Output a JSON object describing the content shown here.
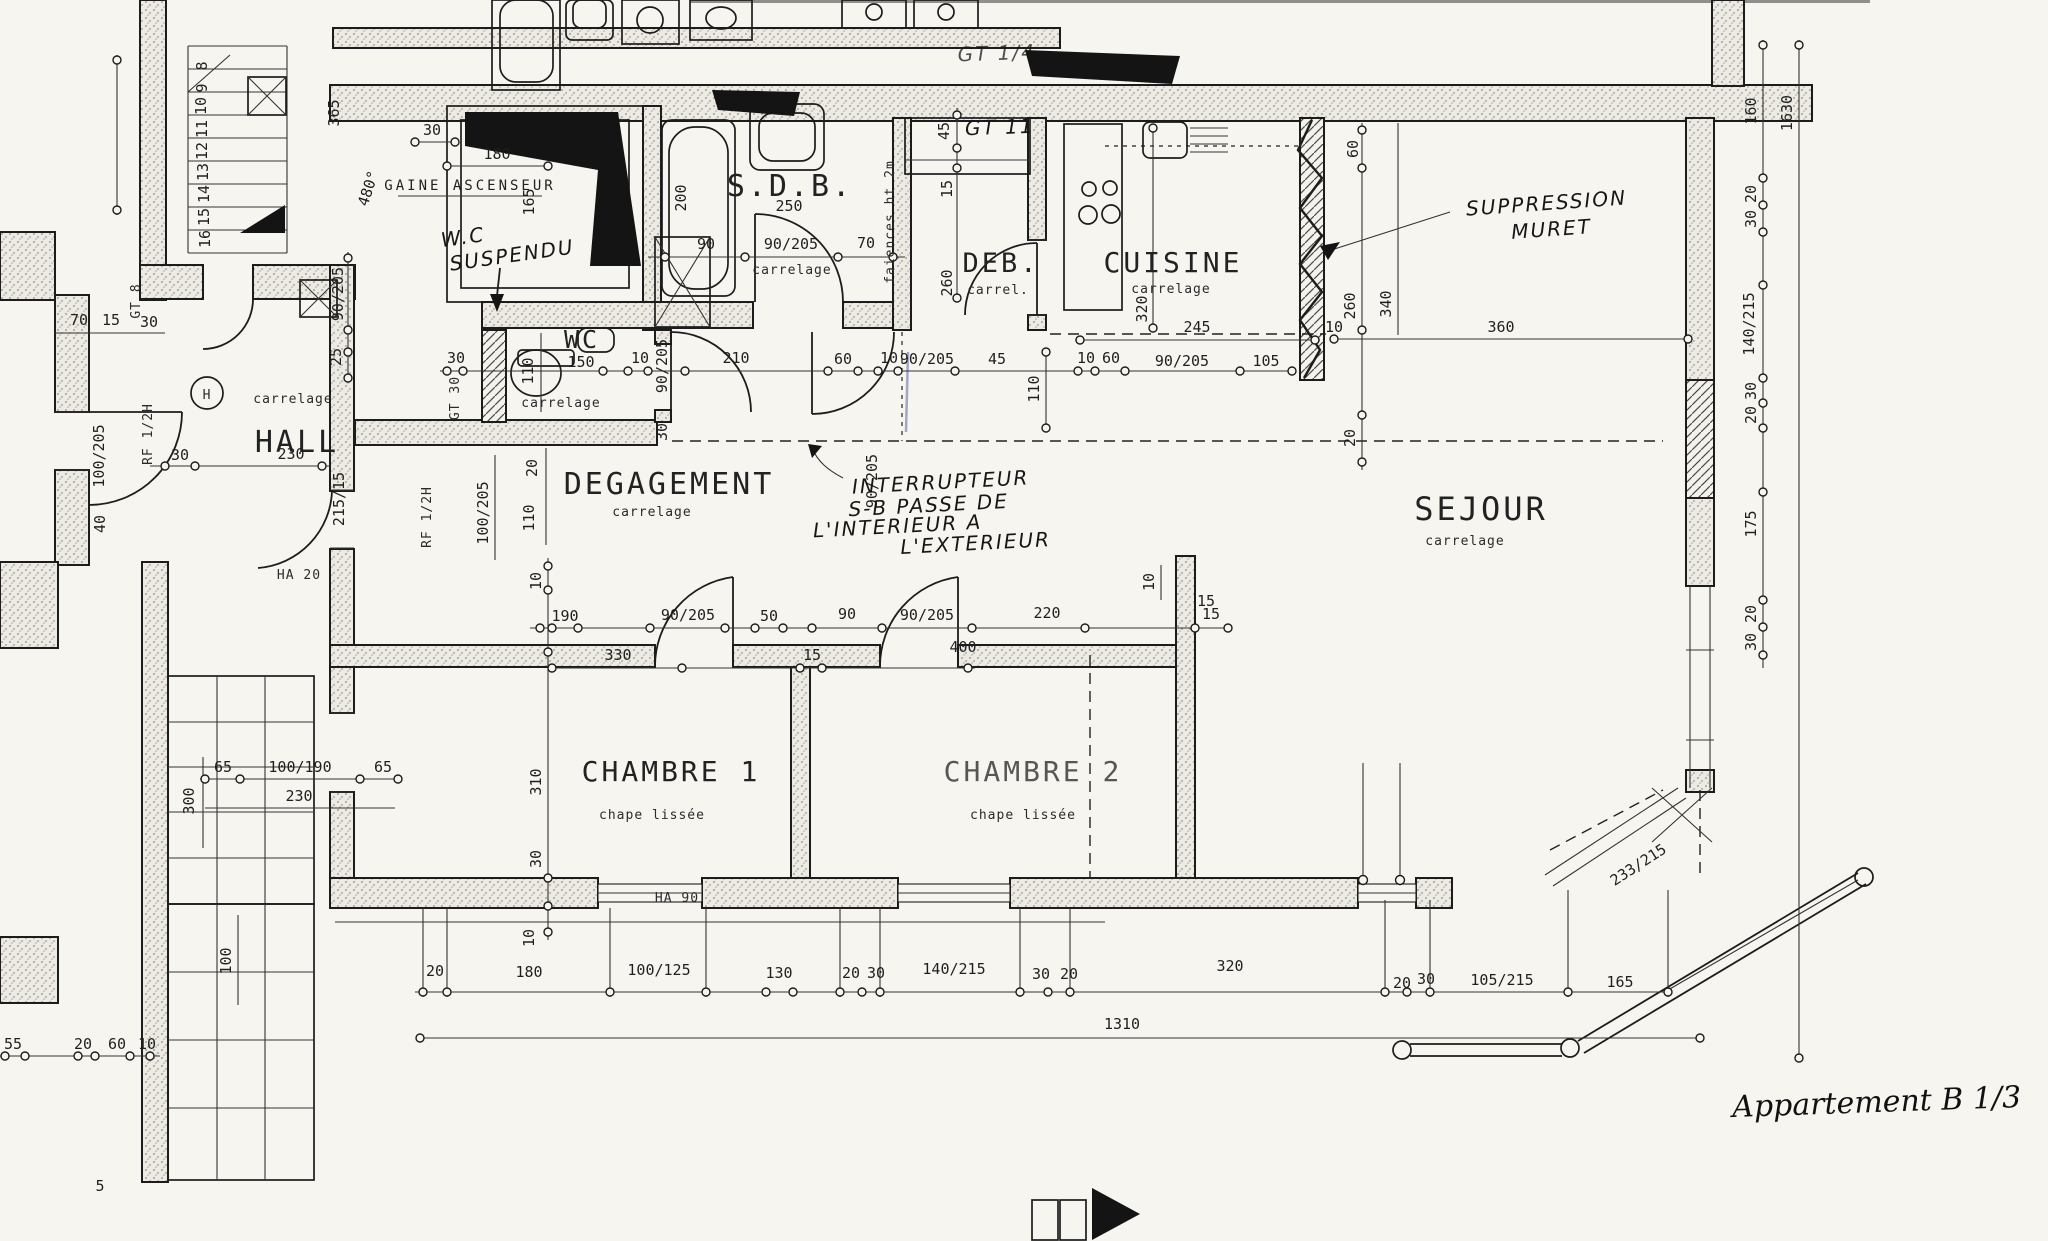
{
  "drawing": {
    "apartment_reference": "Appartement B 1/3",
    "plan_type_rooms": [
      "HALL",
      "DEGAGEMENT",
      "WC",
      "S.D.B.",
      "DEB.",
      "CUISINE",
      "SEJOUR",
      "CHAMBRE 1",
      "CHAMBRE 2",
      "GAINE ASCENSEUR"
    ],
    "floor_finishes": [
      "carrelage",
      "chape lissée",
      "faiences ht 2m"
    ],
    "handwritten_notes": [
      "W.C SUSPENDU",
      "SUPPRESSION MURET",
      "INTERRUPTEUR S-B PASSE DE L'INTERIEUR A L'EXTERIEUR",
      "GT 11",
      "Appartement B 1/3"
    ]
  },
  "labels": {
    "rooms": [
      {
        "t": "HALL",
        "x": 297,
        "y": 452,
        "s": 30
      },
      {
        "t": "DEGAGEMENT",
        "x": 669,
        "y": 494,
        "s": 30
      },
      {
        "t": "S.D.B.",
        "x": 790,
        "y": 196,
        "s": 30
      },
      {
        "t": "DEB.",
        "x": 1001,
        "y": 272,
        "s": 27
      },
      {
        "t": "CUISINE",
        "x": 1173,
        "y": 272,
        "s": 28
      },
      {
        "t": "SEJOUR",
        "x": 1481,
        "y": 520,
        "s": 32
      },
      {
        "t": "CHAMBRE 1",
        "x": 671,
        "y": 781,
        "s": 28
      },
      {
        "t": "CHAMBRE 2",
        "x": 1033,
        "y": 781,
        "s": 28,
        "o": 0.75
      },
      {
        "t": "WC",
        "x": 582,
        "y": 348,
        "s": 25
      },
      {
        "t": "GAINE ASCENSEUR",
        "x": 470,
        "y": 190,
        "s": 14
      }
    ],
    "subs": [
      {
        "t": "carrelage",
        "x": 293,
        "y": 403
      },
      {
        "t": "carrelage",
        "x": 652,
        "y": 516
      },
      {
        "t": "carrelage",
        "x": 561,
        "y": 407
      },
      {
        "t": "carrelage",
        "x": 792,
        "y": 274
      },
      {
        "t": "carrel.",
        "x": 998,
        "y": 294
      },
      {
        "t": "carrelage",
        "x": 1171,
        "y": 293
      },
      {
        "t": "carrelage",
        "x": 1465,
        "y": 545
      },
      {
        "t": "chape lissée",
        "x": 652,
        "y": 819
      },
      {
        "t": "chape lissée",
        "x": 1023,
        "y": 819
      },
      {
        "t": "HA 20",
        "x": 299,
        "y": 579,
        "s": 15
      },
      {
        "t": "HA 90",
        "x": 677,
        "y": 902,
        "s": 15
      },
      {
        "t": "faiences ht 2m",
        "x": 894,
        "y": 222,
        "r": -90
      },
      {
        "t": "RF 1/2H",
        "x": 152,
        "y": 434,
        "r": -90
      },
      {
        "t": "RF 1/2H",
        "x": 431,
        "y": 517,
        "r": -90
      },
      {
        "t": "GT 8",
        "x": 140,
        "y": 301,
        "r": -90,
        "s": 12
      },
      {
        "t": "GT 30",
        "x": 459,
        "y": 398,
        "r": -90,
        "s": 12
      },
      {
        "t": "H",
        "x": 207,
        "y": 399,
        "s": 16
      }
    ],
    "dims": [
      {
        "t": "365",
        "x": 339,
        "y": 113,
        "r": -90
      },
      {
        "t": "30",
        "x": 432,
        "y": 135
      },
      {
        "t": "180",
        "x": 497,
        "y": 159
      },
      {
        "t": "165",
        "x": 534,
        "y": 202,
        "r": -90
      },
      {
        "t": "480°",
        "x": 373,
        "y": 190,
        "r": -72
      },
      {
        "t": "70",
        "x": 79,
        "y": 325
      },
      {
        "t": "15",
        "x": 111,
        "y": 325
      },
      {
        "t": "30",
        "x": 149,
        "y": 327
      },
      {
        "t": "90/205",
        "x": 343,
        "y": 294,
        "r": -90
      },
      {
        "t": "25",
        "x": 341,
        "y": 357,
        "r": -90
      },
      {
        "t": "100/205",
        "x": 104,
        "y": 456,
        "r": -90
      },
      {
        "t": "30",
        "x": 180,
        "y": 460
      },
      {
        "t": "40",
        "x": 105,
        "y": 524,
        "r": -90
      },
      {
        "t": "230",
        "x": 291,
        "y": 459
      },
      {
        "t": "215/15",
        "x": 344,
        "y": 499,
        "r": -90
      },
      {
        "t": "200",
        "x": 686,
        "y": 198,
        "r": -90
      },
      {
        "t": "250",
        "x": 789,
        "y": 211
      },
      {
        "t": "90",
        "x": 706,
        "y": 249
      },
      {
        "t": "90/205",
        "x": 791,
        "y": 249
      },
      {
        "t": "70",
        "x": 866,
        "y": 248
      },
      {
        "t": "45",
        "x": 949,
        "y": 131,
        "r": -90
      },
      {
        "t": "15",
        "x": 952,
        "y": 189,
        "r": -90
      },
      {
        "t": "260",
        "x": 952,
        "y": 283,
        "r": -90
      },
      {
        "t": "30",
        "x": 456,
        "y": 363
      },
      {
        "t": "110",
        "x": 533,
        "y": 371,
        "r": -90
      },
      {
        "t": "150",
        "x": 581,
        "y": 367
      },
      {
        "t": "10",
        "x": 640,
        "y": 363
      },
      {
        "t": "90/205",
        "x": 667,
        "y": 366,
        "r": -90
      },
      {
        "t": "210",
        "x": 736,
        "y": 363
      },
      {
        "t": "30",
        "x": 667,
        "y": 432,
        "r": -90
      },
      {
        "t": "60",
        "x": 843,
        "y": 364
      },
      {
        "t": "10",
        "x": 889,
        "y": 363
      },
      {
        "t": "90/205",
        "x": 927,
        "y": 364
      },
      {
        "t": "45",
        "x": 997,
        "y": 364
      },
      {
        "t": "10",
        "x": 1086,
        "y": 363
      },
      {
        "t": "60",
        "x": 1111,
        "y": 363
      },
      {
        "t": "90/205",
        "x": 1182,
        "y": 366
      },
      {
        "t": "105",
        "x": 1266,
        "y": 366
      },
      {
        "t": "245",
        "x": 1197,
        "y": 332
      },
      {
        "t": "320",
        "x": 1147,
        "y": 309,
        "r": -90
      },
      {
        "t": "20",
        "x": 537,
        "y": 468,
        "r": -90
      },
      {
        "t": "110",
        "x": 534,
        "y": 518,
        "r": -90
      },
      {
        "t": "100/205",
        "x": 488,
        "y": 513,
        "r": -90
      },
      {
        "t": "90/205",
        "x": 877,
        "y": 481,
        "r": -90
      },
      {
        "t": "60",
        "x": 1358,
        "y": 149,
        "r": -90
      },
      {
        "t": "260",
        "x": 1355,
        "y": 306,
        "r": -90
      },
      {
        "t": "340",
        "x": 1391,
        "y": 304,
        "r": -90
      },
      {
        "t": "10",
        "x": 1334,
        "y": 332
      },
      {
        "t": "360",
        "x": 1501,
        "y": 332
      },
      {
        "t": "20",
        "x": 1355,
        "y": 438,
        "r": -90
      },
      {
        "t": "110",
        "x": 1039,
        "y": 389,
        "r": -90
      },
      {
        "t": "15",
        "x": 1206,
        "y": 606
      },
      {
        "t": "160",
        "x": 1756,
        "y": 111,
        "r": -90
      },
      {
        "t": "1630",
        "x": 1792,
        "y": 113,
        "r": -90
      },
      {
        "t": "20",
        "x": 1756,
        "y": 194,
        "r": -90
      },
      {
        "t": "30",
        "x": 1756,
        "y": 219,
        "r": -90
      },
      {
        "t": "140/215",
        "x": 1754,
        "y": 324,
        "r": -90
      },
      {
        "t": "30",
        "x": 1756,
        "y": 391,
        "r": -90
      },
      {
        "t": "20",
        "x": 1756,
        "y": 415,
        "r": -90
      },
      {
        "t": "175",
        "x": 1756,
        "y": 524,
        "r": -90
      },
      {
        "t": "20",
        "x": 1756,
        "y": 614,
        "r": -90
      },
      {
        "t": "30",
        "x": 1756,
        "y": 642,
        "r": -90
      },
      {
        "t": "10",
        "x": 541,
        "y": 581,
        "r": -90
      },
      {
        "t": "190",
        "x": 565,
        "y": 621
      },
      {
        "t": "90/205",
        "x": 688,
        "y": 620
      },
      {
        "t": "50",
        "x": 769,
        "y": 621
      },
      {
        "t": "90",
        "x": 847,
        "y": 619
      },
      {
        "t": "90/205",
        "x": 927,
        "y": 620
      },
      {
        "t": "220",
        "x": 1047,
        "y": 618
      },
      {
        "t": "15",
        "x": 1211,
        "y": 619
      },
      {
        "t": "330",
        "x": 618,
        "y": 660
      },
      {
        "t": "15",
        "x": 812,
        "y": 660
      },
      {
        "t": "400",
        "x": 963,
        "y": 652
      },
      {
        "t": "10",
        "x": 1154,
        "y": 582,
        "r": -90
      },
      {
        "t": "310",
        "x": 541,
        "y": 782,
        "r": -90
      },
      {
        "t": "30",
        "x": 541,
        "y": 859,
        "r": -90
      },
      {
        "t": "65",
        "x": 223,
        "y": 772
      },
      {
        "t": "100/190",
        "x": 300,
        "y": 772
      },
      {
        "t": "65",
        "x": 383,
        "y": 772
      },
      {
        "t": "230",
        "x": 299,
        "y": 801
      },
      {
        "t": "300",
        "x": 194,
        "y": 801,
        "r": -90
      },
      {
        "t": "100",
        "x": 231,
        "y": 961,
        "r": -90
      },
      {
        "t": "20",
        "x": 435,
        "y": 976
      },
      {
        "t": "180",
        "x": 529,
        "y": 977
      },
      {
        "t": "100/125",
        "x": 659,
        "y": 975
      },
      {
        "t": "130",
        "x": 779,
        "y": 978
      },
      {
        "t": "20",
        "x": 851,
        "y": 978
      },
      {
        "t": "30",
        "x": 876,
        "y": 978
      },
      {
        "t": "140/215",
        "x": 954,
        "y": 974
      },
      {
        "t": "30",
        "x": 1041,
        "y": 979
      },
      {
        "t": "20",
        "x": 1069,
        "y": 979
      },
      {
        "t": "320",
        "x": 1230,
        "y": 971
      },
      {
        "t": "20",
        "x": 1402,
        "y": 988
      },
      {
        "t": "30",
        "x": 1426,
        "y": 984
      },
      {
        "t": "105/215",
        "x": 1502,
        "y": 985
      },
      {
        "t": "165",
        "x": 1620,
        "y": 987
      },
      {
        "t": "10",
        "x": 534,
        "y": 938,
        "r": -90
      },
      {
        "t": "1310",
        "x": 1122,
        "y": 1029
      },
      {
        "t": "233/215",
        "x": 1641,
        "y": 869,
        "r": -33
      },
      {
        "t": "55",
        "x": 13,
        "y": 1049
      },
      {
        "t": "20",
        "x": 83,
        "y": 1049
      },
      {
        "t": "60",
        "x": 117,
        "y": 1049
      },
      {
        "t": "10",
        "x": 147,
        "y": 1049
      },
      {
        "t": "5",
        "x": 100,
        "y": 1191
      },
      {
        "t": "8",
        "x": 207,
        "y": 66,
        "r": -90,
        "s": 12
      },
      {
        "t": "9",
        "x": 207,
        "y": 88,
        "r": -90,
        "s": 12
      },
      {
        "t": "10",
        "x": 206,
        "y": 106,
        "r": -90,
        "s": 12
      },
      {
        "t": "11",
        "x": 207,
        "y": 129,
        "r": -90,
        "s": 12
      },
      {
        "t": "12",
        "x": 207,
        "y": 151,
        "r": -90,
        "s": 12
      },
      {
        "t": "13",
        "x": 208,
        "y": 172,
        "r": -90,
        "s": 12
      },
      {
        "t": "14",
        "x": 209,
        "y": 194,
        "r": -90,
        "s": 12
      },
      {
        "t": "15",
        "x": 209,
        "y": 217,
        "r": -90,
        "s": 12
      },
      {
        "t": "16",
        "x": 210,
        "y": 239,
        "r": -90,
        "s": 12
      }
    ],
    "hand": [
      {
        "t": "W.C",
        "x": 464,
        "y": 244,
        "r": -8,
        "s": 21
      },
      {
        "t": "SUSPENDU",
        "x": 513,
        "y": 262,
        "r": -8,
        "s": 20
      },
      {
        "t": "SUPPRESSION",
        "x": 1547,
        "y": 210,
        "r": -4,
        "s": 24
      },
      {
        "t": "MURET",
        "x": 1552,
        "y": 236,
        "r": -4,
        "s": 24
      },
      {
        "t": "INTERRUPTEUR",
        "x": 941,
        "y": 489,
        "r": -3,
        "s": 19
      },
      {
        "t": "S-B PASSE DE",
        "x": 929,
        "y": 512,
        "r": -3,
        "s": 19
      },
      {
        "t": "L'INTERIEUR A",
        "x": 898,
        "y": 533,
        "r": -3,
        "s": 19
      },
      {
        "t": "L'EXTERIEUR",
        "x": 976,
        "y": 550,
        "r": -3,
        "s": 19
      },
      {
        "t": "GT 11",
        "x": 1000,
        "y": 134,
        "r": -2,
        "s": 15
      },
      {
        "t": "GT 1/4",
        "x": 997,
        "y": 60,
        "r": -2,
        "s": 12,
        "o": 0.75
      }
    ],
    "script": [
      {
        "t": "Appartement B 1/3",
        "x": 1877,
        "y": 1112,
        "s": 30,
        "r": -2
      }
    ]
  }
}
